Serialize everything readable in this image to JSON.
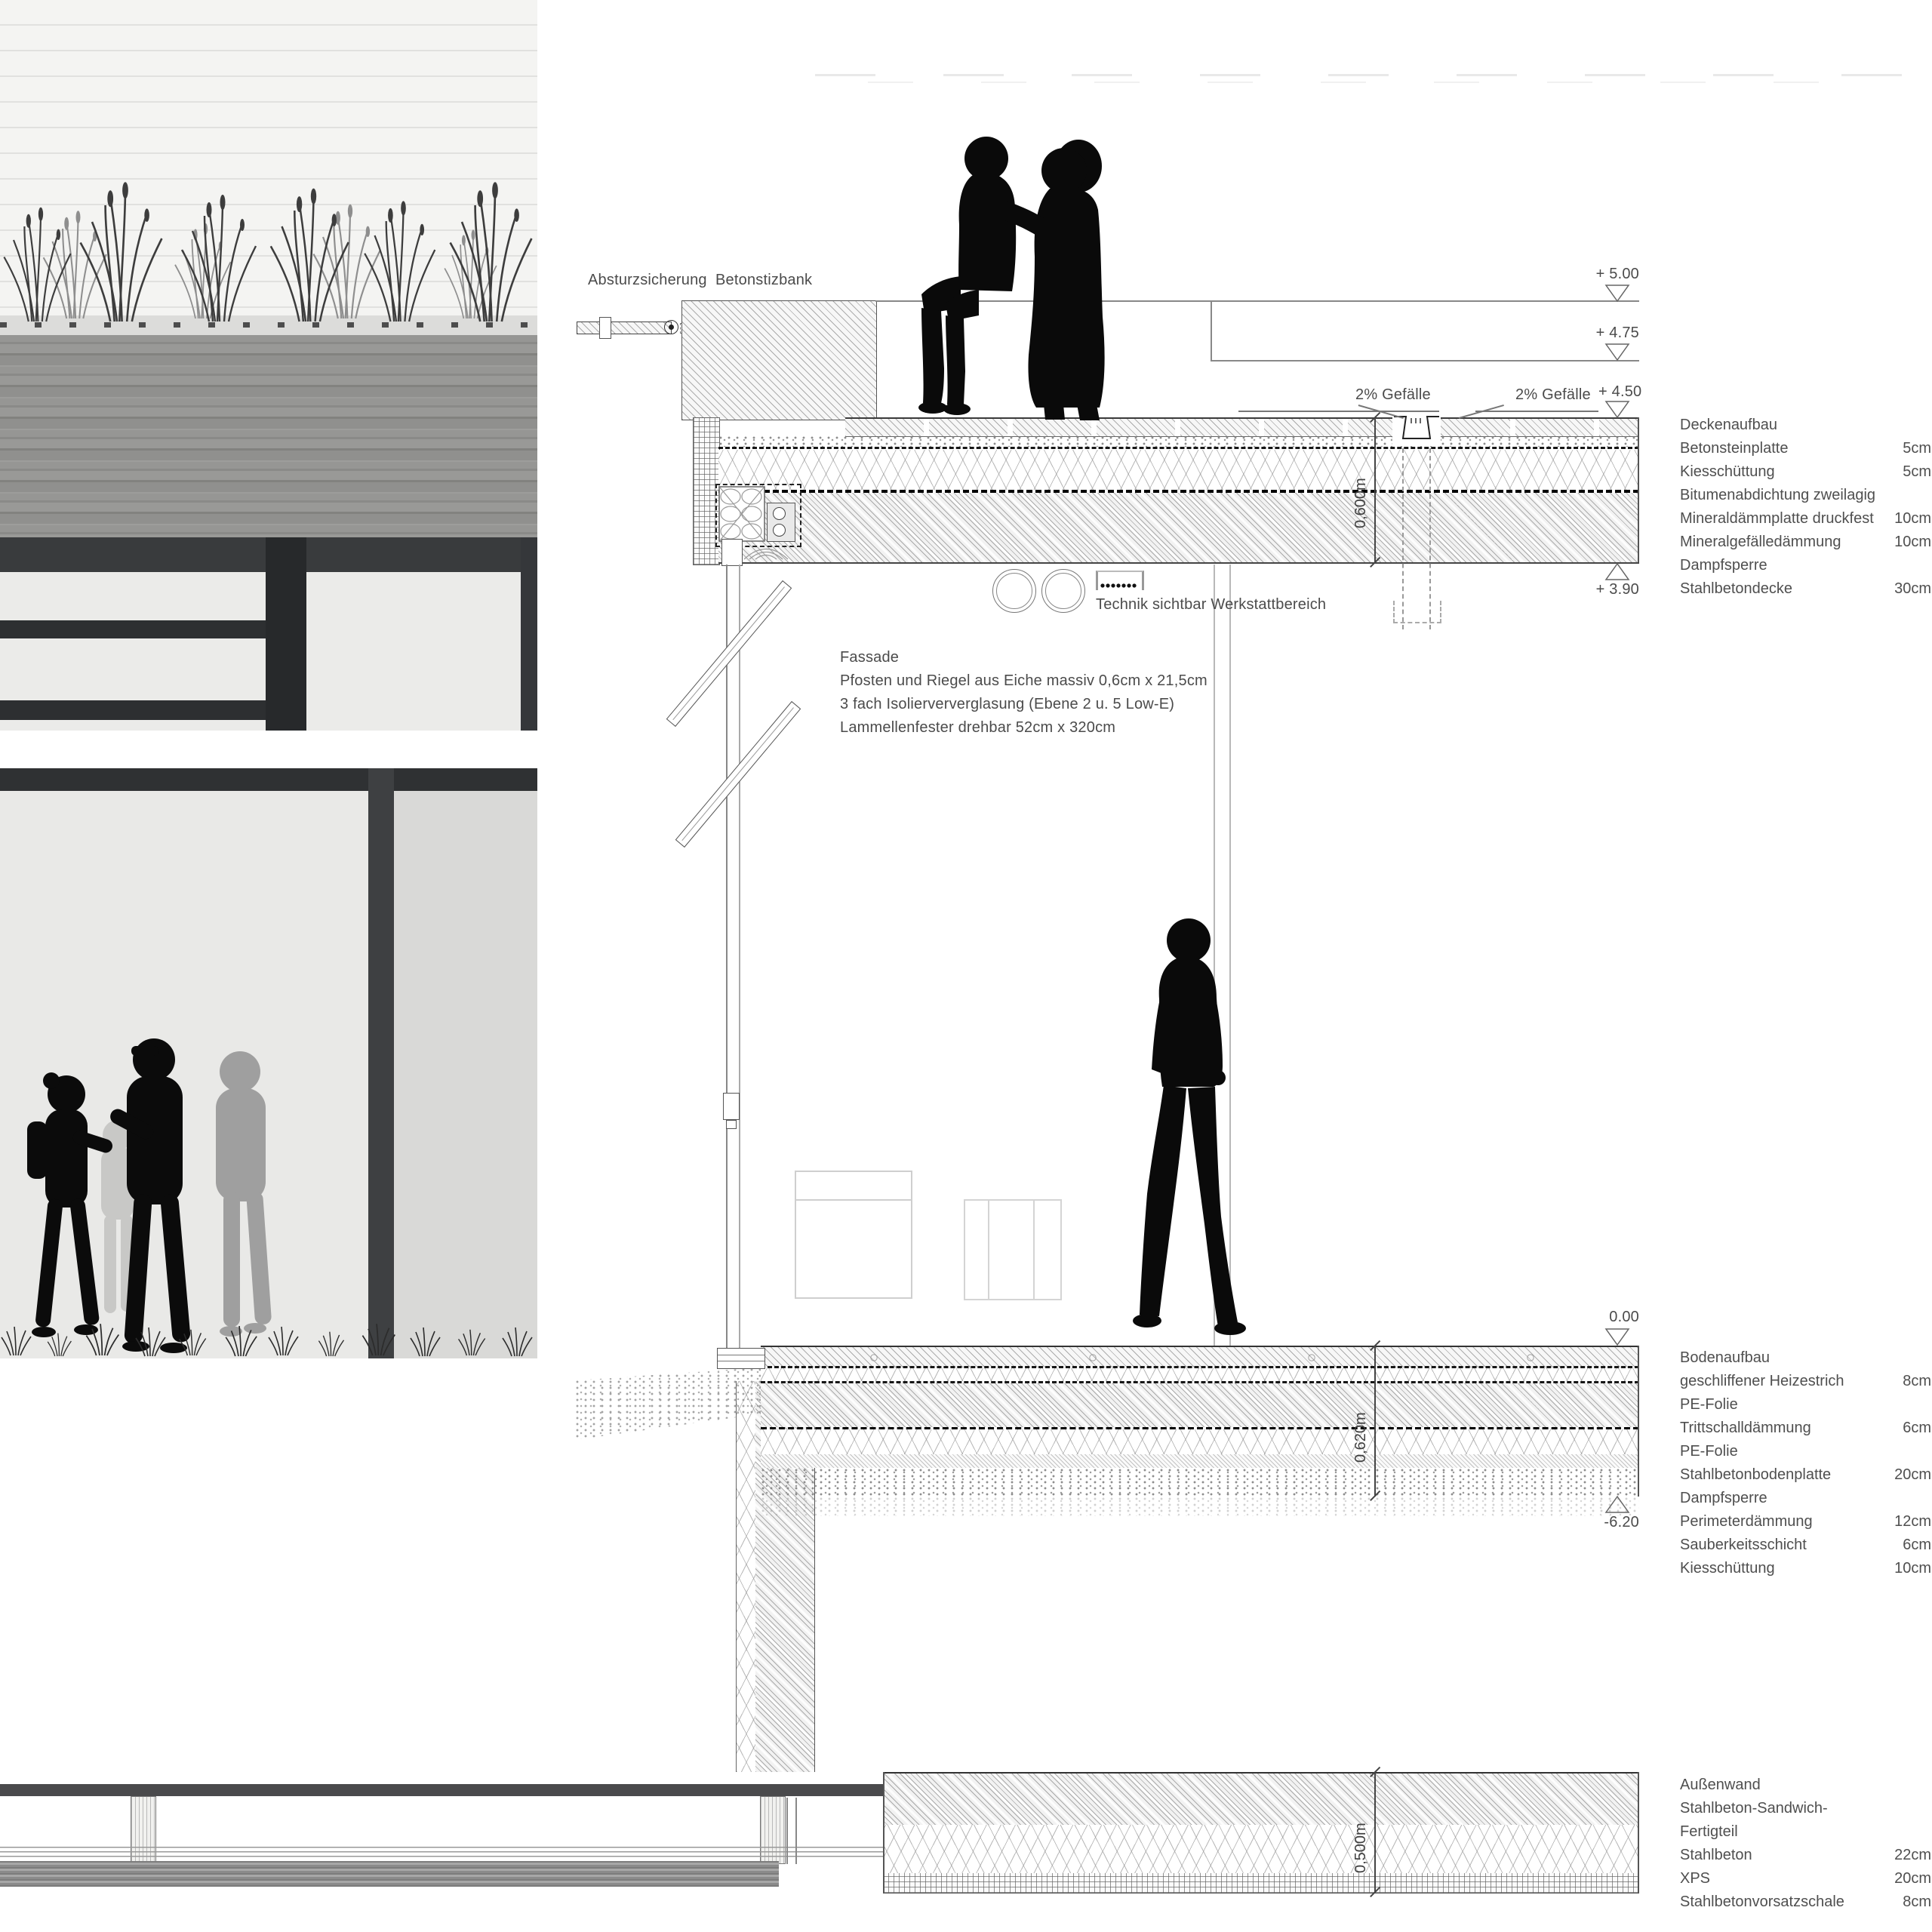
{
  "annotations": {
    "absturzsicherung": "Absturzsicherung",
    "betonsitzbank": "Betonstizbank",
    "slope_left": "2% Gefälle",
    "slope_right": "2% Gefälle",
    "technik": "Technik sichtbar Werkstattbereich",
    "fassade_title": "Fassade",
    "fassade_line1": "Pfosten und Riegel aus Eiche massiv 0,6cm x 21,5cm",
    "fassade_line2": "3 fach Isolierververglasung (Ebene 2 u. 5 Low-E)",
    "fassade_line3": "Lammellenfester drehbar 52cm x 320cm"
  },
  "levels": {
    "p500": "+ 5.00",
    "p475": "+ 4.75",
    "p450": "+ 4.50",
    "p390": "+ 3.90",
    "zero": "0.00",
    "m620": "-6.20"
  },
  "dimensions": {
    "roof": "0,600m",
    "floor": "0,620m",
    "wall": "0,500m"
  },
  "legend_roof": {
    "title": "Deckenaufbau",
    "rows": [
      {
        "label": "Betonsteinplatte",
        "value": "5cm"
      },
      {
        "label": "Kiesschüttung",
        "value": "5cm"
      },
      {
        "label": "Bitumenabdichtung zweilagig",
        "value": ""
      },
      {
        "label": "Mineraldämmplatte druckfest",
        "value": "10cm"
      },
      {
        "label": "Mineralgefälledämmung",
        "value": "10cm"
      },
      {
        "label": "Dampfsperre",
        "value": ""
      },
      {
        "label": "Stahlbetondecke",
        "value": "30cm"
      }
    ]
  },
  "legend_floor": {
    "title": "Bodenaufbau",
    "rows": [
      {
        "label": "geschliffener Heizestrich",
        "value": "8cm"
      },
      {
        "label": "PE-Folie",
        "value": ""
      },
      {
        "label": "Trittschalldämmung",
        "value": "6cm"
      },
      {
        "label": "PE-Folie",
        "value": ""
      },
      {
        "label": "Stahlbetonbodenplatte",
        "value": "20cm"
      },
      {
        "label": "Dampfsperre",
        "value": ""
      },
      {
        "label": "Perimeterdämmung",
        "value": "12cm"
      },
      {
        "label": "Sauberkeitsschicht",
        "value": "6cm"
      },
      {
        "label": "Kiesschüttung",
        "value": "10cm"
      }
    ]
  },
  "legend_wall": {
    "title": "Außenwand",
    "rows": [
      {
        "label": "Stahlbeton-Sandwich-",
        "value": ""
      },
      {
        "label": "Fertigteil",
        "value": ""
      },
      {
        "label": "Stahlbeton",
        "value": "22cm"
      },
      {
        "label": "XPS",
        "value": "20cm"
      },
      {
        "label": "Stahlbetonvorsatzschale",
        "value": "8cm"
      }
    ]
  }
}
